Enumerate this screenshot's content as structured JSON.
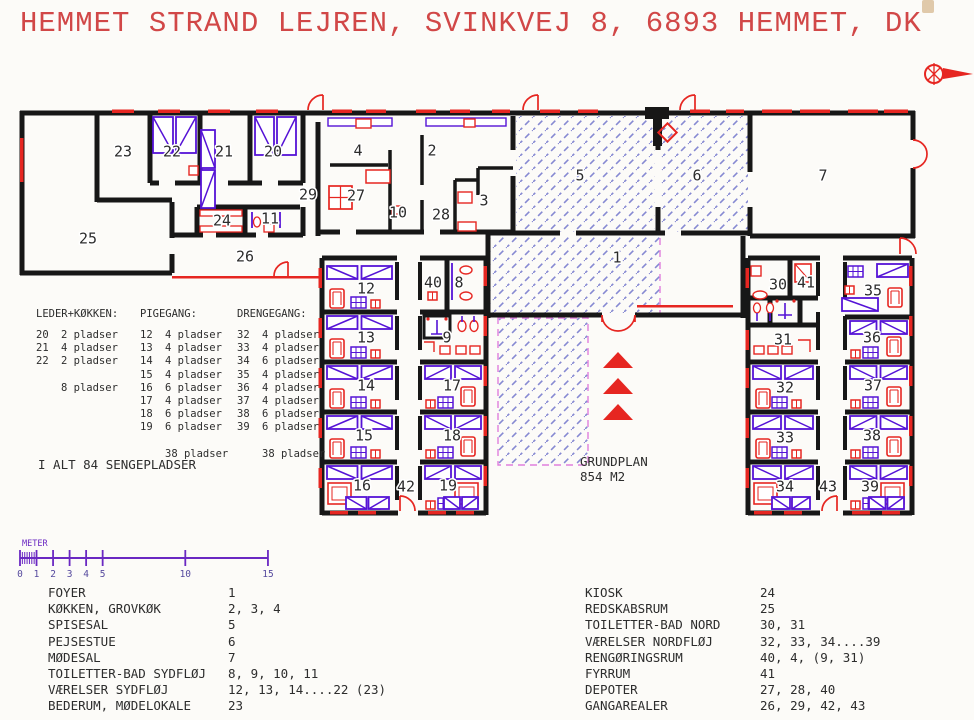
{
  "title": "HEMMET STRAND LEJREN, SVINKVEJ 8, 6893 HEMMET, DK",
  "colors": {
    "title_red": "#d14747",
    "wall_black": "#171717",
    "furniture_purple": "#5513d6",
    "accent_red": "#e62621",
    "hatch_blue": "#8689d2",
    "terrace_magenta": "#e07fdd",
    "scale_purple": "#6a28c2",
    "label_ink": "#2c2c2c"
  },
  "plan": {
    "grundplan": {
      "line1": "GRUNDPLAN",
      "line2": "854 M2"
    },
    "rooms": [
      {
        "n": "23",
        "x": 123,
        "y": 152
      },
      {
        "n": "22",
        "x": 172,
        "y": 152
      },
      {
        "n": "21",
        "x": 224,
        "y": 152
      },
      {
        "n": "20",
        "x": 273,
        "y": 152
      },
      {
        "n": "25",
        "x": 88,
        "y": 239
      },
      {
        "n": "24",
        "x": 222,
        "y": 221
      },
      {
        "n": "11",
        "x": 270,
        "y": 219
      },
      {
        "n": "26",
        "x": 245,
        "y": 257
      },
      {
        "n": "29",
        "x": 308,
        "y": 195
      },
      {
        "n": "4",
        "x": 358,
        "y": 151
      },
      {
        "n": "27",
        "x": 356,
        "y": 196
      },
      {
        "n": "10",
        "x": 398,
        "y": 213
      },
      {
        "n": "28",
        "x": 441,
        "y": 215
      },
      {
        "n": "2",
        "x": 432,
        "y": 151
      },
      {
        "n": "3",
        "x": 484,
        "y": 201
      },
      {
        "n": "5",
        "x": 580,
        "y": 176
      },
      {
        "n": "6",
        "x": 697,
        "y": 176
      },
      {
        "n": "7",
        "x": 823,
        "y": 176
      },
      {
        "n": "1",
        "x": 617,
        "y": 258
      },
      {
        "n": "12",
        "x": 366,
        "y": 289
      },
      {
        "n": "13",
        "x": 366,
        "y": 338
      },
      {
        "n": "14",
        "x": 366,
        "y": 386
      },
      {
        "n": "15",
        "x": 364,
        "y": 436
      },
      {
        "n": "16",
        "x": 362,
        "y": 486
      },
      {
        "n": "40",
        "x": 433,
        "y": 283
      },
      {
        "n": "8",
        "x": 459,
        "y": 283
      },
      {
        "n": "9",
        "x": 447,
        "y": 338
      },
      {
        "n": "17",
        "x": 452,
        "y": 386
      },
      {
        "n": "18",
        "x": 452,
        "y": 436
      },
      {
        "n": "19",
        "x": 448,
        "y": 486
      },
      {
        "n": "42",
        "x": 406,
        "y": 487
      },
      {
        "n": "30",
        "x": 778,
        "y": 285
      },
      {
        "n": "41",
        "x": 806,
        "y": 283
      },
      {
        "n": "35",
        "x": 873,
        "y": 291
      },
      {
        "n": "31",
        "x": 783,
        "y": 340
      },
      {
        "n": "36",
        "x": 872,
        "y": 338
      },
      {
        "n": "32",
        "x": 785,
        "y": 388
      },
      {
        "n": "37",
        "x": 873,
        "y": 386
      },
      {
        "n": "33",
        "x": 785,
        "y": 438
      },
      {
        "n": "38",
        "x": 872,
        "y": 436
      },
      {
        "n": "34",
        "x": 785,
        "y": 487
      },
      {
        "n": "43",
        "x": 828,
        "y": 487
      },
      {
        "n": "39",
        "x": 870,
        "y": 487
      }
    ]
  },
  "capacity": {
    "columns": [
      {
        "header": "LEDER+KØKKEN:",
        "rows": [
          [
            "20",
            "2 pladser"
          ],
          [
            "21",
            "4 pladser"
          ],
          [
            "22",
            "2 pladser"
          ],
          [
            "",
            ""
          ],
          [
            "",
            "8 pladser"
          ]
        ]
      },
      {
        "header": "PIGEGANG:",
        "rows": [
          [
            "12",
            "4 pladser"
          ],
          [
            "13",
            "4 pladser"
          ],
          [
            "14",
            "4 pladser"
          ],
          [
            "15",
            "4 pladser"
          ],
          [
            "16",
            "6 pladser"
          ],
          [
            "17",
            "4 pladser"
          ],
          [
            "18",
            "6 pladser"
          ],
          [
            "19",
            "6 pladser"
          ],
          [
            "",
            ""
          ],
          [
            "",
            "38 pladser"
          ]
        ]
      },
      {
        "header": "DRENGEGANG:",
        "rows": [
          [
            "32",
            "4 pladser"
          ],
          [
            "33",
            "4 pladser"
          ],
          [
            "34",
            "6 pladser"
          ],
          [
            "35",
            "4 pladser"
          ],
          [
            "36",
            "4 pladser"
          ],
          [
            "37",
            "4 pladser"
          ],
          [
            "38",
            "6 pladser"
          ],
          [
            "39",
            "6 pladser"
          ],
          [
            "",
            ""
          ],
          [
            "",
            "38 pladser"
          ]
        ]
      }
    ],
    "total": "I ALT 84 SENGEPLADSER"
  },
  "scale": {
    "label": "METER",
    "ticks": [
      "0",
      "1",
      "2",
      "3",
      "4",
      "5",
      "10",
      "15"
    ],
    "tick_values": [
      0,
      1,
      2,
      3,
      4,
      5,
      10,
      15
    ]
  },
  "room_index": {
    "left": [
      [
        "FOYER",
        "1"
      ],
      [
        "KØKKEN, GROVKØK",
        "2, 3, 4"
      ],
      [
        "SPISESAL",
        "5"
      ],
      [
        "PEJSESTUE",
        "6"
      ],
      [
        "MØDESAL",
        "7"
      ],
      [
        "TOILETTER-BAD SYDFLØJ",
        "8, 9, 10, 11"
      ],
      [
        "VÆRELSER SYDFLØJ",
        "12, 13, 14....22 (23)"
      ],
      [
        "BEDERUM, MØDELOKALE",
        "23"
      ]
    ],
    "right": [
      [
        "KIOSK",
        "24"
      ],
      [
        "REDSKABSRUM",
        "25"
      ],
      [
        "TOILETTER-BAD NORD",
        "30, 31"
      ],
      [
        "VÆRELSER NORDFLØJ",
        "32, 33, 34....39"
      ],
      [
        "RENGØRINGSRUM",
        "40, 4, (9, 31)"
      ],
      [
        "FYRRUM",
        "41"
      ],
      [
        "DEPOTER",
        "27, 28, 40"
      ],
      [
        "GANGAREALER",
        "26, 29, 42, 43"
      ]
    ]
  }
}
